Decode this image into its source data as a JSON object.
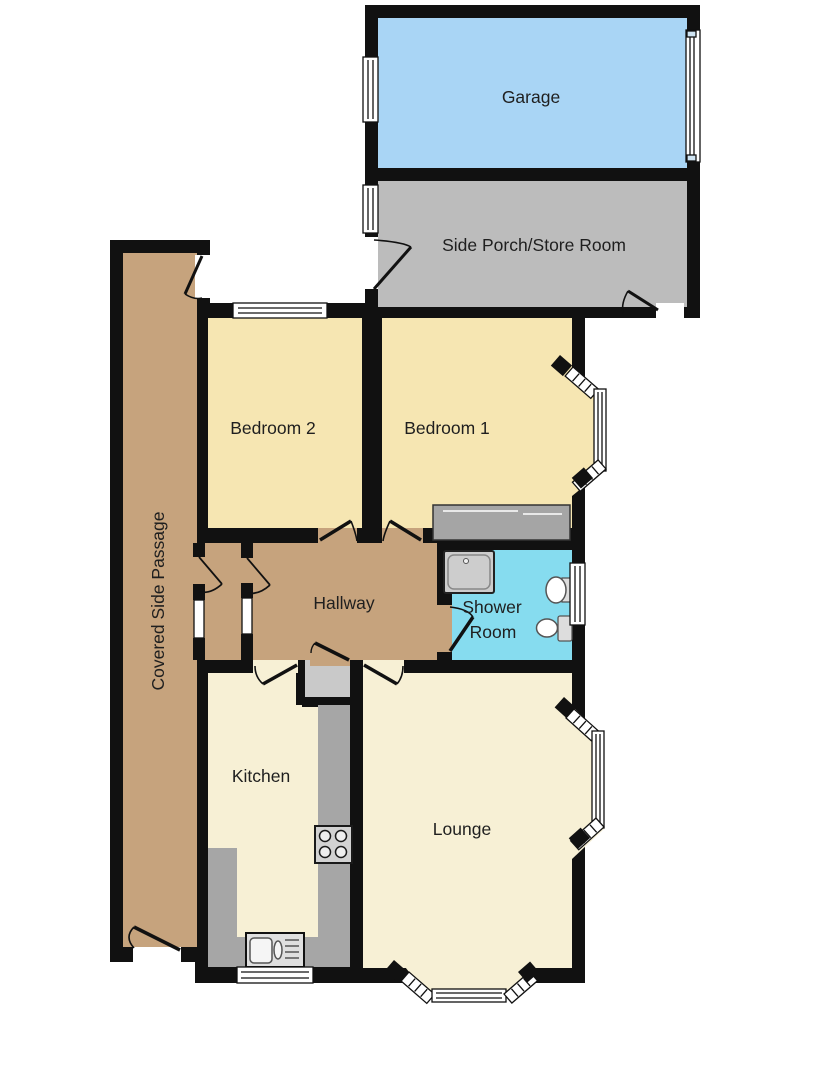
{
  "plan": {
    "type": "floorplan",
    "rooms": {
      "garage": {
        "label": "Garage"
      },
      "porch": {
        "label": "Side Porch/Store Room"
      },
      "bedroom2": {
        "label": "Bedroom 2"
      },
      "bedroom1": {
        "label": "Bedroom 1"
      },
      "passage": {
        "label": "Covered Side Passage"
      },
      "hallway": {
        "label": "Hallway"
      },
      "shower": {
        "label": "Shower Room",
        "lines": [
          "Shower",
          "Room"
        ]
      },
      "kitchen": {
        "label": "Kitchen"
      },
      "lounge": {
        "label": "Lounge"
      }
    },
    "fixtures": {
      "shower_tray": "shower-tray-icon",
      "basin": "wash-basin-icon",
      "toilet": "toilet-icon",
      "hob": "hob-icon",
      "sink": "kitchen-sink-drainer-icon",
      "garage_door": "garage-door-icon",
      "wardrobe": "built-in-wardrobe-icon",
      "cupboard": "cupboard-icon",
      "worktop": "kitchen-worktop-icon",
      "window": "window-icon",
      "door": "door-swing-icon"
    }
  },
  "colors": {
    "wall": "#111111",
    "garage": "#a9d5f5",
    "porch": "#bcbcbc",
    "bedroom": "#f6e6b2",
    "passage": "#c6a37d",
    "hallway": "#c6a37d",
    "shower": "#86dcef",
    "kitchen": "#f7f0d5",
    "lounge": "#f7f0d5",
    "counter": "#a6a6a6",
    "cupboard": "#c9c9c9",
    "wardrobe": "#a5a5a5",
    "window": "#ffffff",
    "label": "#1f1f1f"
  }
}
